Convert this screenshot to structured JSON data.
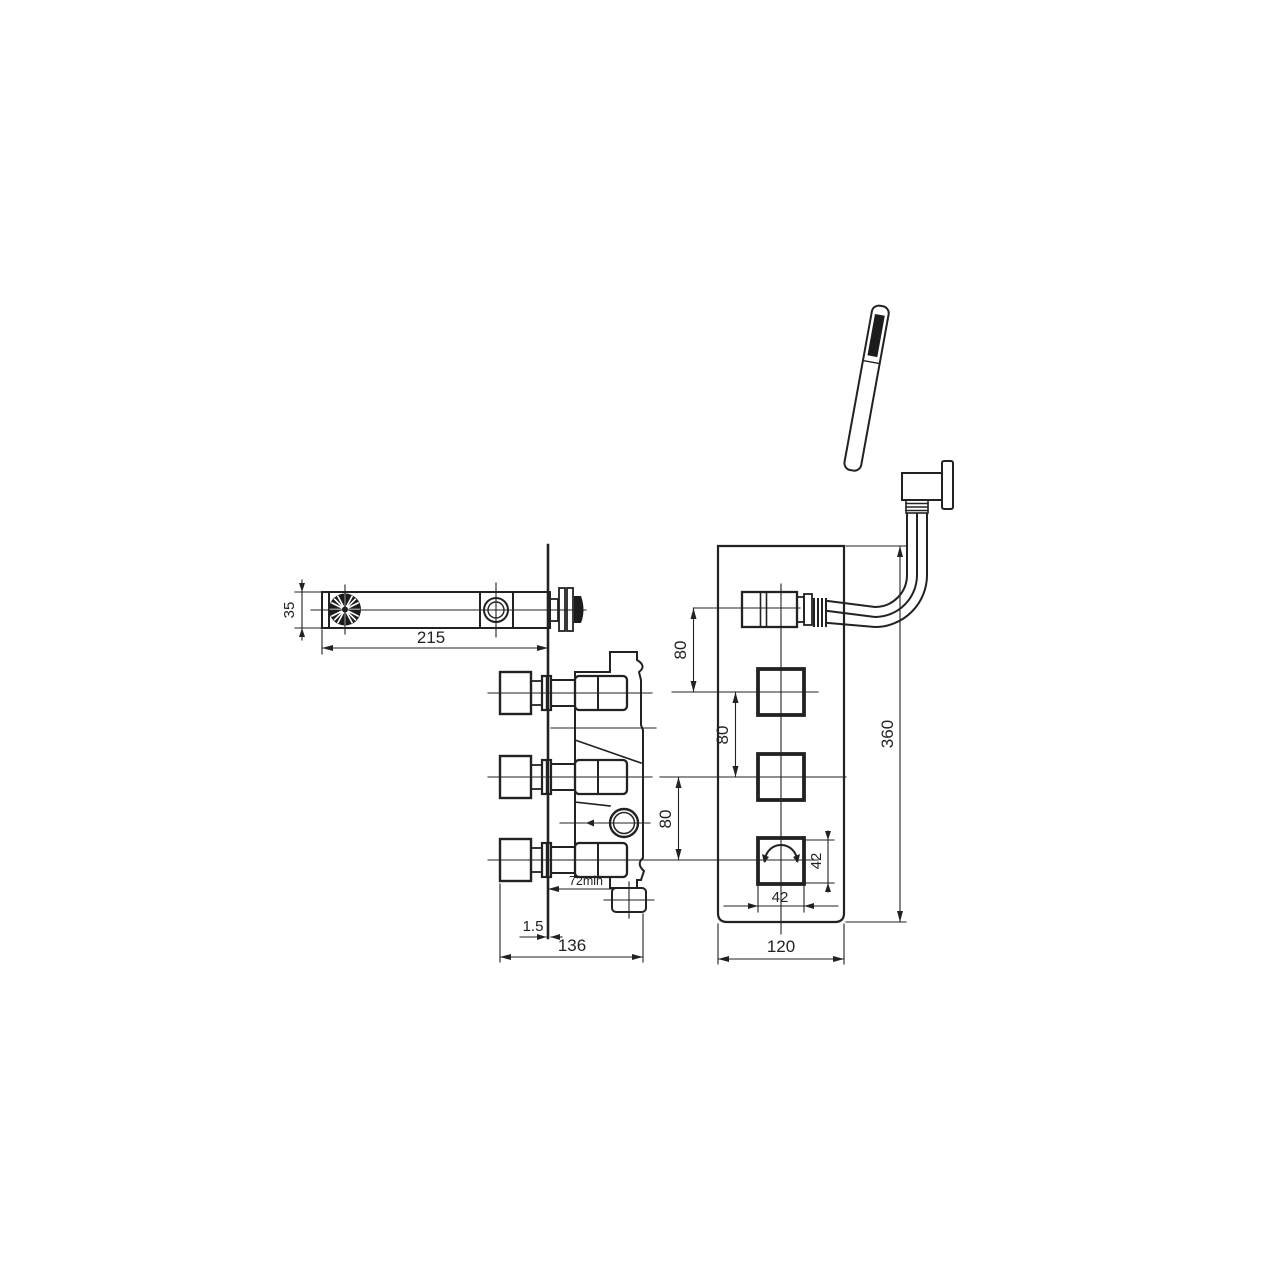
{
  "drawing": {
    "background": "#ffffff",
    "line_color": "#222222",
    "views": {
      "spout_side": {
        "dims": {
          "spout_height": "35",
          "spout_length": "215"
        }
      },
      "valve_side": {
        "dims": {
          "wall_thickness": "1.5",
          "body_depth": "136",
          "min_recess": "72min"
        }
      },
      "front_panel": {
        "dims": {
          "spacing_top": "80",
          "spacing_mid": "80",
          "spacing_bottom": "80",
          "plate_height": "360",
          "handle_width": "42",
          "handle_height": "42",
          "plate_width": "120"
        }
      }
    }
  }
}
